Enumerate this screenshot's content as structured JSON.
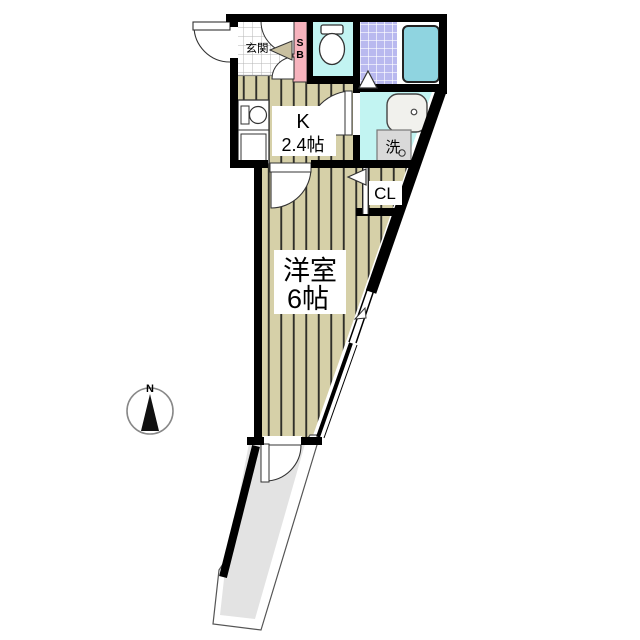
{
  "plan": {
    "genkan_label": "玄関",
    "shoebox_s": "S",
    "shoebox_b": "B",
    "kitchen_letter": "K",
    "kitchen_size": "2.4帖",
    "washer_label": "洗",
    "closet_label": "CL",
    "room_name": "洋室",
    "room_size": "6帖",
    "compass_north": "N"
  },
  "colors": {
    "wall": "#000000",
    "flooring": "#d6d0a8",
    "flooring_stripe": "#30302a",
    "genkan_tile_line": "#b4b4b4",
    "wet_area": "#c2f4f2",
    "bath_tile": "#b9b9ef",
    "bathtub": "#8fd4e0",
    "shoe_box": "#f7b3bd",
    "balcony_floor": "#e3e3e3",
    "washer_box": "#d9d9d9",
    "door_wedge": "#c9c0a0",
    "label_bg": "#ffffff"
  }
}
